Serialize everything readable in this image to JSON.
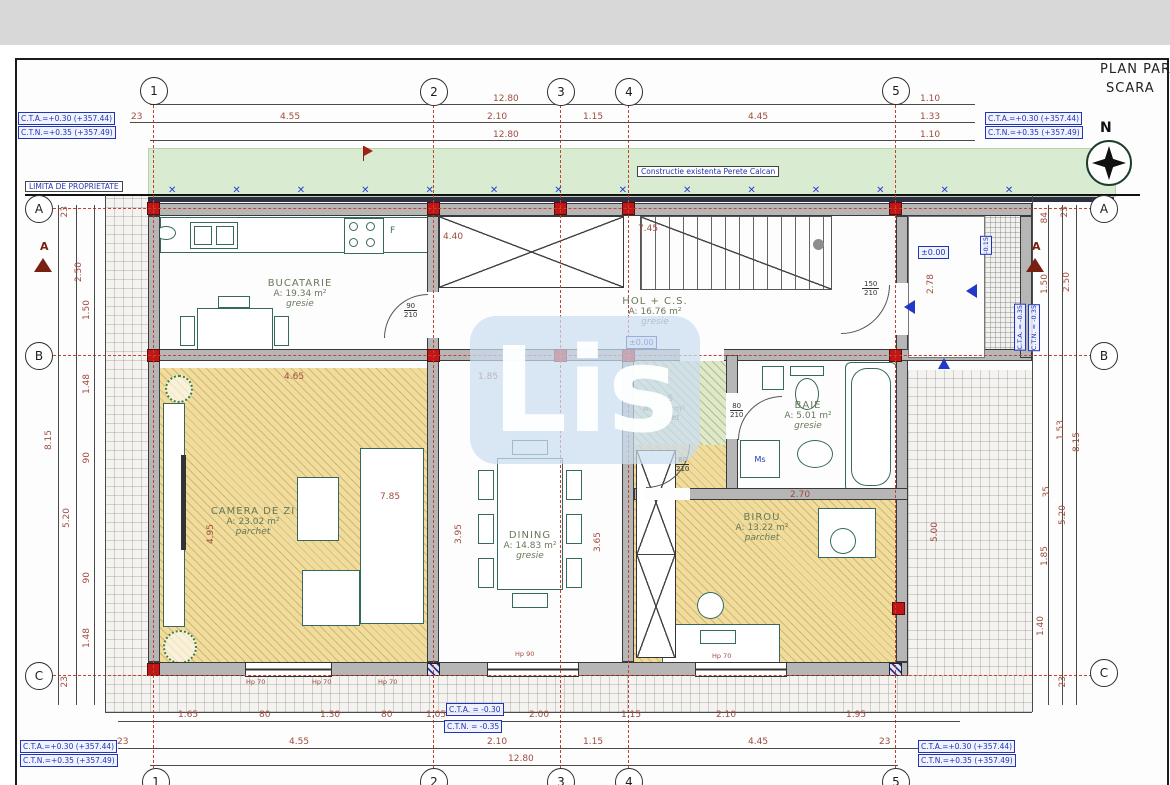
{
  "meta": {
    "title_line1": "PLAN PAR",
    "title_line2": "SCARA",
    "north": "N"
  },
  "watermark": {
    "text": "Lis"
  },
  "boundary": {
    "label": "LIMITA DE PROPRIETATE",
    "marks": "✕✕✕✕✕✕✕✕✕✕✕✕✕✕"
  },
  "strip": {
    "label": "Constructie existenta Perete Calcan"
  },
  "grid": {
    "c1": "1",
    "c2": "2",
    "c3": "3",
    "c4": "4",
    "c5": "5",
    "rA": "A",
    "rB": "B",
    "rC": "C"
  },
  "section": {
    "left": "A",
    "right": "A"
  },
  "corner_boxes": {
    "tl1": "C.T.A.=+0.30 (+357.44)",
    "tl2": "C.T.N.=+0.35 (+357.49)",
    "tr1": "C.T.A.=+0.30 (+357.44)",
    "tr2": "C.T.N.=+0.35 (+357.49)",
    "bl1": "C.T.A.=+0.30 (+357.44)",
    "bl2": "C.T.N.=+0.35 (+357.49)",
    "br1": "C.T.A.=+0.30 (+357.44)",
    "br2": "C.T.N.=+0.35 (+357.49)"
  },
  "levels": {
    "hol": "±0.00",
    "porch": "±0.00",
    "minus015": "-0.15",
    "cta_bottom": "C.T.A. = -0.30",
    "ctn_bottom": "C.T.N. = -0.35",
    "cta_right": "C.T.A. = -0.35",
    "ctn_right": "C.T.N. = -0.35"
  },
  "rooms": {
    "bucatarie": {
      "name": "BUCATARIE",
      "area": "A: 19.34 m²",
      "floor": "gresie"
    },
    "hol": {
      "name": "HOL + C.S.",
      "area": "A: 16.76 m²",
      "floor": "gresie"
    },
    "camera": {
      "name": "CAMERA DE ZI",
      "area": "A: 23.02 m²",
      "floor": "parchet"
    },
    "dining": {
      "name": "DINING",
      "area": "A: 14.83 m²",
      "floor": "gresie"
    },
    "sas": {
      "name": "SAS",
      "area": "A: 2.17 m²",
      "floor": "parchet"
    },
    "baie": {
      "name": "BAIE",
      "area": "A: 5.01 m²",
      "floor": "gresie"
    },
    "birou": {
      "name": "BIROU",
      "area": "A: 13.22 m²",
      "floor": "parchet"
    }
  },
  "doors": {
    "kitchen": {
      "w": "90",
      "h": "210"
    },
    "hall": {
      "w": "150",
      "h": "210"
    },
    "baie": {
      "w": "80",
      "h": "210"
    },
    "sas": {
      "w": "80",
      "h": "210"
    }
  },
  "appliances": {
    "washing_machine": "Ms",
    "hood": "F"
  },
  "dims": {
    "top": {
      "total1": "12.80",
      "r1_right": "1.10",
      "row": [
        "23",
        "4.55",
        "2.10",
        "1.15",
        "4.45"
      ],
      "row_right": "1.33",
      "total2": "12.80",
      "r3_right": "1.10"
    },
    "bottom": {
      "row1": [
        "1.65",
        "80",
        "1.30",
        "80",
        "1.05",
        "2.00",
        "1.15",
        "2.10",
        "1.95"
      ],
      "row2": [
        "23",
        "4.55",
        "2.10",
        "1.15",
        "4.45",
        "23"
      ],
      "total": "12.80"
    },
    "left": [
      "23",
      "2.50",
      "1.50",
      "1.48",
      "8.15",
      "90",
      "5.20",
      "90",
      "1.48",
      "23"
    ],
    "right": [
      "23",
      "84",
      "2.50",
      "1.50",
      "1.53",
      "8.15",
      "35",
      "5.20",
      "1.85",
      "1.40",
      "23"
    ],
    "inner": {
      "kitchen": "4.40",
      "stairs": "7.45",
      "hol_b": "1.85",
      "living_w": "4.65",
      "living_d": "7.85",
      "living_h": "4.95",
      "dining_h": "3.95",
      "dining_h2": "3.65",
      "birou_w": "2.70",
      "porch_h": "2.78",
      "terrace_h": "5.00"
    },
    "windows": [
      "Hp 70",
      "Hp 70",
      "Hp 70",
      "Hp 90",
      "Hp 70"
    ]
  }
}
